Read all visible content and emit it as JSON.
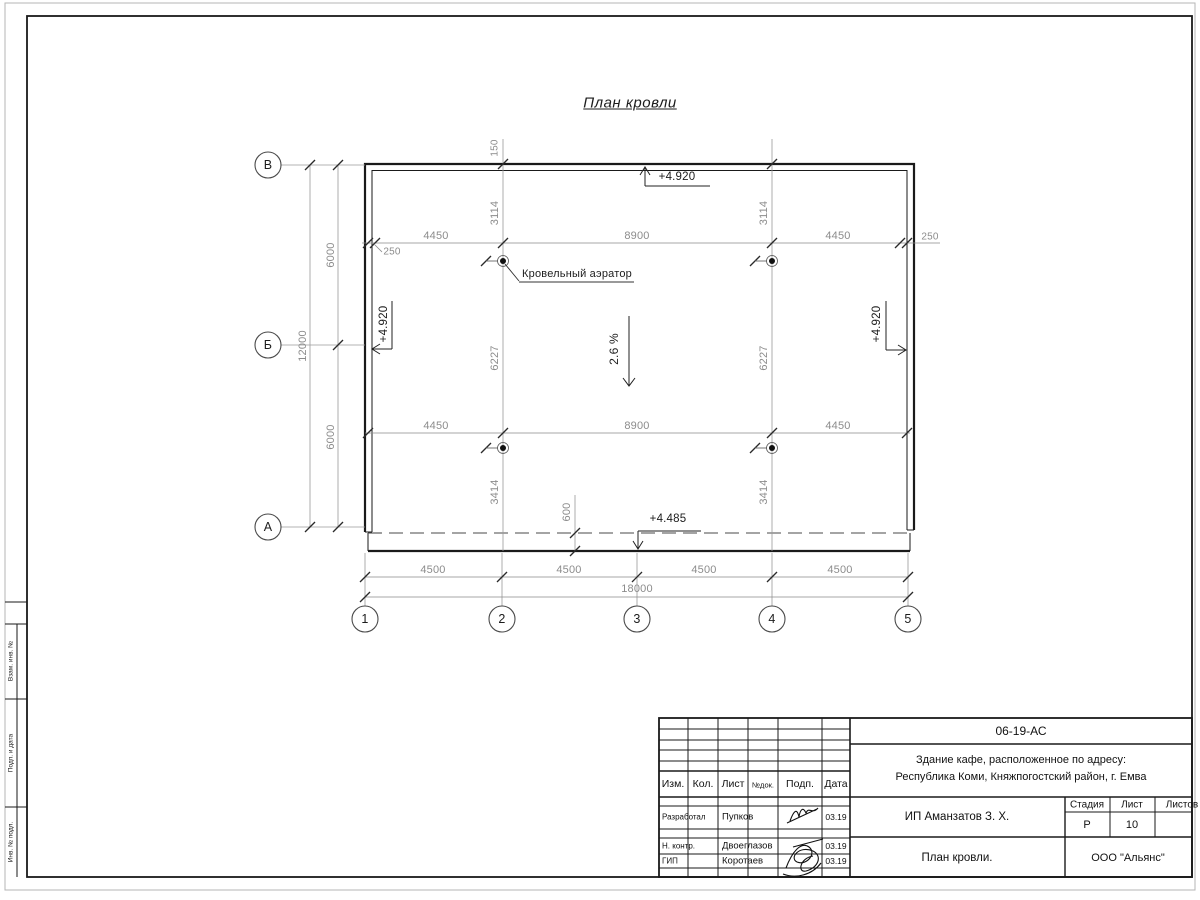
{
  "sheet": {
    "title": "План кровли",
    "slope": "2.6 %",
    "aerator_label": "Кровельный аэратор",
    "elevations": {
      "top": "+4.920",
      "left": "+4.920",
      "right": "+4.920",
      "eave": "+4.485"
    },
    "dims": {
      "overhang": "150",
      "eave_offset": "600",
      "row1": [
        "250",
        "4450",
        "8900",
        "4450",
        "250"
      ],
      "row2": [
        "4450",
        "8900",
        "4450"
      ],
      "col_left": [
        "3114",
        "6227",
        "3414"
      ],
      "col_right": [
        "3114",
        "6227",
        "3414"
      ],
      "side_total": "12000",
      "side_half_1": "6000",
      "side_half_2": "6000",
      "bottom": [
        "4500",
        "4500",
        "4500",
        "4500"
      ],
      "bottom_total": "18000"
    },
    "row_axes": [
      "В",
      "Б",
      "А"
    ],
    "col_axes": [
      "1",
      "2",
      "3",
      "4",
      "5"
    ]
  },
  "title_block": {
    "doc_code": "06-19-АС",
    "address_line1": "Здание кафе, расположенное по адресу:",
    "address_line2": "Республика Коми, Княжпогостский район, г. Емва",
    "client": "ИП Аманзатов З. Х.",
    "sheet_title": "План кровли.",
    "company": "ООО \"Альянс\"",
    "headers": {
      "izm": "Изм.",
      "kol": "Кол.",
      "list": "Лист",
      "ndok": "№док.",
      "podp": "Подп.",
      "data": "Дата"
    },
    "stage_label": "Стадия",
    "sheet_label": "Лист",
    "sheets_label": "Листов",
    "stage": "Р",
    "sheet_no": "10",
    "roles": [
      {
        "role": "Разработал",
        "name": "Пупков",
        "date": "03.19"
      },
      {
        "role": "Н. контр.",
        "name": "Двоеглазов",
        "date": "03.19"
      },
      {
        "role": "ГИП",
        "name": "Коротаев",
        "date": "03.19"
      }
    ]
  },
  "margin_stamps": {
    "zam": "Взам. инв. №",
    "podp": "Подп. и дата",
    "inv": "Инв. № подл."
  }
}
